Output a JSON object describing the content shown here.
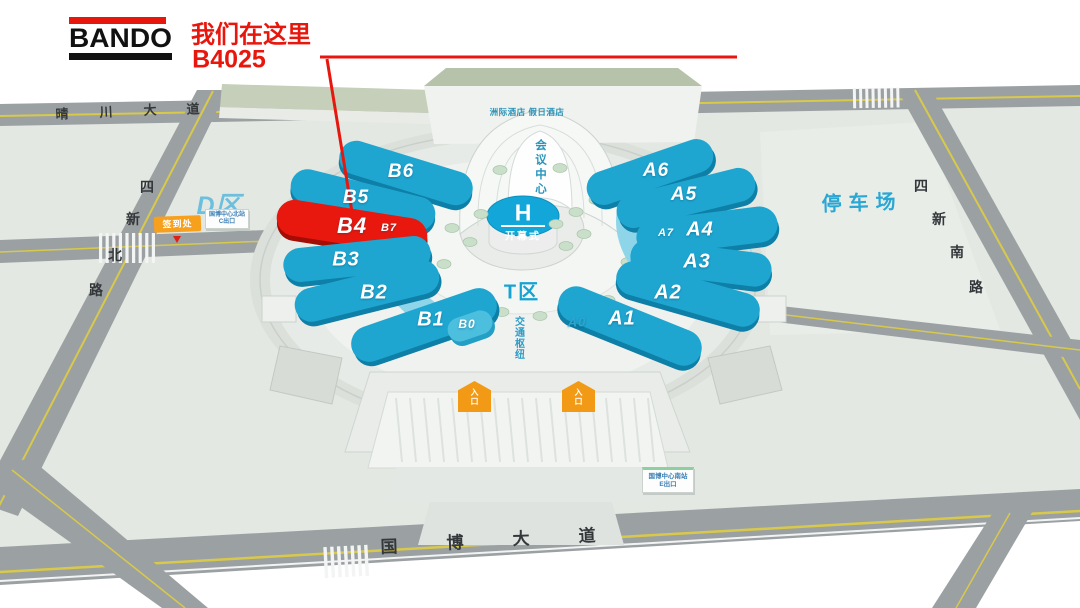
{
  "callout": {
    "logo": "BANDO",
    "line1": "我们在这里",
    "line2": "B4025"
  },
  "map": {
    "hotels_label": "洲际酒店  假日酒店",
    "conference_label": "会议中心",
    "h_pavilion": {
      "label": "H",
      "sub": "开幕式"
    },
    "t_zone_label": "T区",
    "transport_hub_label": "交通枢纽",
    "d_zone_label": "D区",
    "parking_label": "停车场",
    "registration_label": "签到处",
    "entrance_label": "入口",
    "metro_north": {
      "line1": "国博中心北站",
      "line2": "C出口"
    },
    "metro_south": {
      "line1": "国博中心南站",
      "line2": "E出口"
    },
    "halls": [
      {
        "id": "B6",
        "label": "B6",
        "style": "cyan",
        "highlighted": false
      },
      {
        "id": "B5",
        "label": "B5",
        "style": "cyan",
        "highlighted": false
      },
      {
        "id": "B7",
        "label": "B7",
        "style": "red",
        "highlighted": true
      },
      {
        "id": "B4",
        "label": "B4",
        "style": "red",
        "highlighted": true
      },
      {
        "id": "B3",
        "label": "B3",
        "style": "cyan",
        "highlighted": false
      },
      {
        "id": "B2",
        "label": "B2",
        "style": "cyan",
        "highlighted": false
      },
      {
        "id": "B1",
        "label": "B1",
        "style": "cyan",
        "highlighted": false
      },
      {
        "id": "B0",
        "label": "B0",
        "style": "cyan-light",
        "highlighted": false
      },
      {
        "id": "A6",
        "label": "A6",
        "style": "cyan",
        "highlighted": false
      },
      {
        "id": "A5",
        "label": "A5",
        "style": "cyan",
        "highlighted": false
      },
      {
        "id": "A7",
        "label": "A7",
        "style": "cyan-dark",
        "highlighted": false
      },
      {
        "id": "A4",
        "label": "A4",
        "style": "cyan",
        "highlighted": false
      },
      {
        "id": "A3",
        "label": "A3",
        "style": "cyan",
        "highlighted": false
      },
      {
        "id": "A2",
        "label": "A2",
        "style": "cyan",
        "highlighted": false
      },
      {
        "id": "A1",
        "label": "A1",
        "style": "cyan",
        "highlighted": false
      },
      {
        "id": "A0",
        "label": "A0",
        "style": "none",
        "highlighted": false
      }
    ],
    "roads": {
      "qingchuan": [
        "晴",
        "川",
        "大",
        "道"
      ],
      "sixin_north": [
        "四",
        "新",
        "北",
        "路"
      ],
      "sixin_south": [
        "四",
        "新",
        "南",
        "路"
      ],
      "guobo": [
        "国",
        "博",
        "大",
        "道"
      ]
    }
  },
  "colors": {
    "accent_red": "#e8170e",
    "hall_cyan": "#1ea6d1",
    "arc_cyan": "#8ed5e9",
    "label_blue": "#2ba7d4",
    "road_gray": "#9ba0a3",
    "entrance_orange": "#f6a01e"
  }
}
